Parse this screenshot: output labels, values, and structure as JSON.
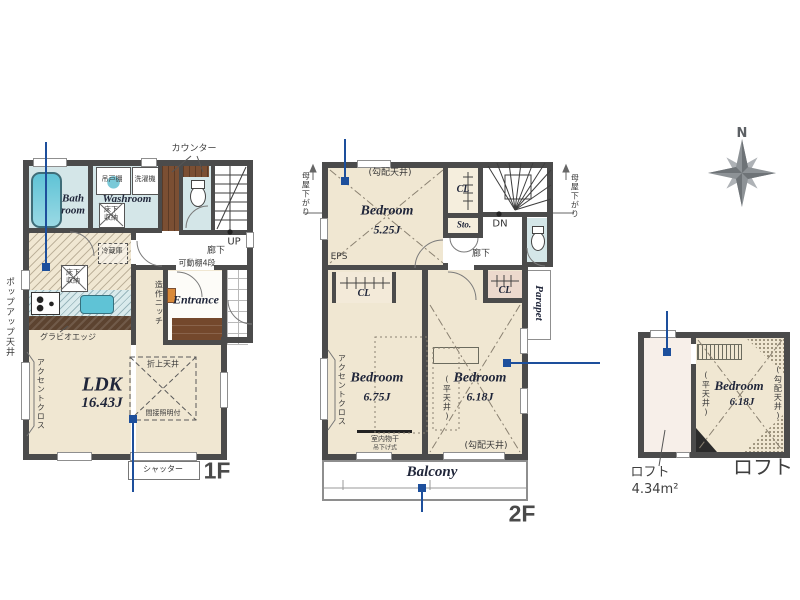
{
  "floor1": {
    "floor_label": "1F",
    "bath_room": "Bath room",
    "washroom": "Washroom",
    "entrance": "Entrance",
    "ldk_name": "LDK",
    "ldk_size": "16.43J",
    "counter": "カウンター",
    "hanging_cupboard": "吊戸棚",
    "washing_machine": "洗濯機",
    "underfloor_storage_washroom": "床下収納",
    "underfloor_storage_kitchen": "床下収納",
    "refrigerator": "冷蔵庫",
    "up": "UP",
    "hallway": "廊下",
    "movable_shelf": "可動棚4段",
    "built_in_niche": "造作ニッチ",
    "coved_ceiling": "折上天井",
    "indirect_lighting": "間接照明付",
    "gravio_edge": "グラビオエッジ",
    "accent_cloth": "アクセントクロス",
    "popup_ceiling": "ポップアップ天井",
    "shutter": "シャッター"
  },
  "floor2": {
    "floor_label": "2F",
    "bedroom1_name": "Bedroom",
    "bedroom1_size": "5.25J",
    "bedroom2_name": "Bedroom",
    "bedroom2_size": "6.75J",
    "bedroom3_name": "Bedroom",
    "bedroom3_size": "6.18J",
    "sloped_ceiling_top": "(勾配天井)",
    "sloped_ceiling_bottom": "(勾配天井)",
    "flat_ceiling": "(平天井)",
    "cl_top": "CL",
    "cl_left": "CL",
    "cl_right": "CL",
    "storage": "Sto.",
    "dn": "DN",
    "hallway": "廊下",
    "eps": "EPS",
    "parapet": "Parapet",
    "balcony": "Balcony",
    "moya_sagari_left": "母屋下がり",
    "moya_sagari_right": "母屋下がり",
    "accent_cloth": "アクセントクロス",
    "indoor_drying": "室内物干",
    "hanging_type": "吊下げ式"
  },
  "loft": {
    "plan_label": "ロフト",
    "area_name": "ロフト",
    "area_size": "4.34m²",
    "bedroom_name": "Bedroom",
    "bedroom_size": "6.18J",
    "flat_ceiling": "(平天井)",
    "sloped_ceiling": "(勾配天井)"
  },
  "compass": {
    "north": "N"
  },
  "colors": {
    "wall": "#4b4b4b",
    "floor_beige": "#f0e7d2",
    "water_blue": "#d4e6e8",
    "bathtub": "#6ec7d8",
    "wood_brown": "#7b4f33",
    "genkan_brown": "#6f4529",
    "marker_blue": "#1d4f9c",
    "loft_pink": "#f7efe9",
    "closet_pink": "#ecd9cd",
    "compass_gray": "#8d9296"
  }
}
